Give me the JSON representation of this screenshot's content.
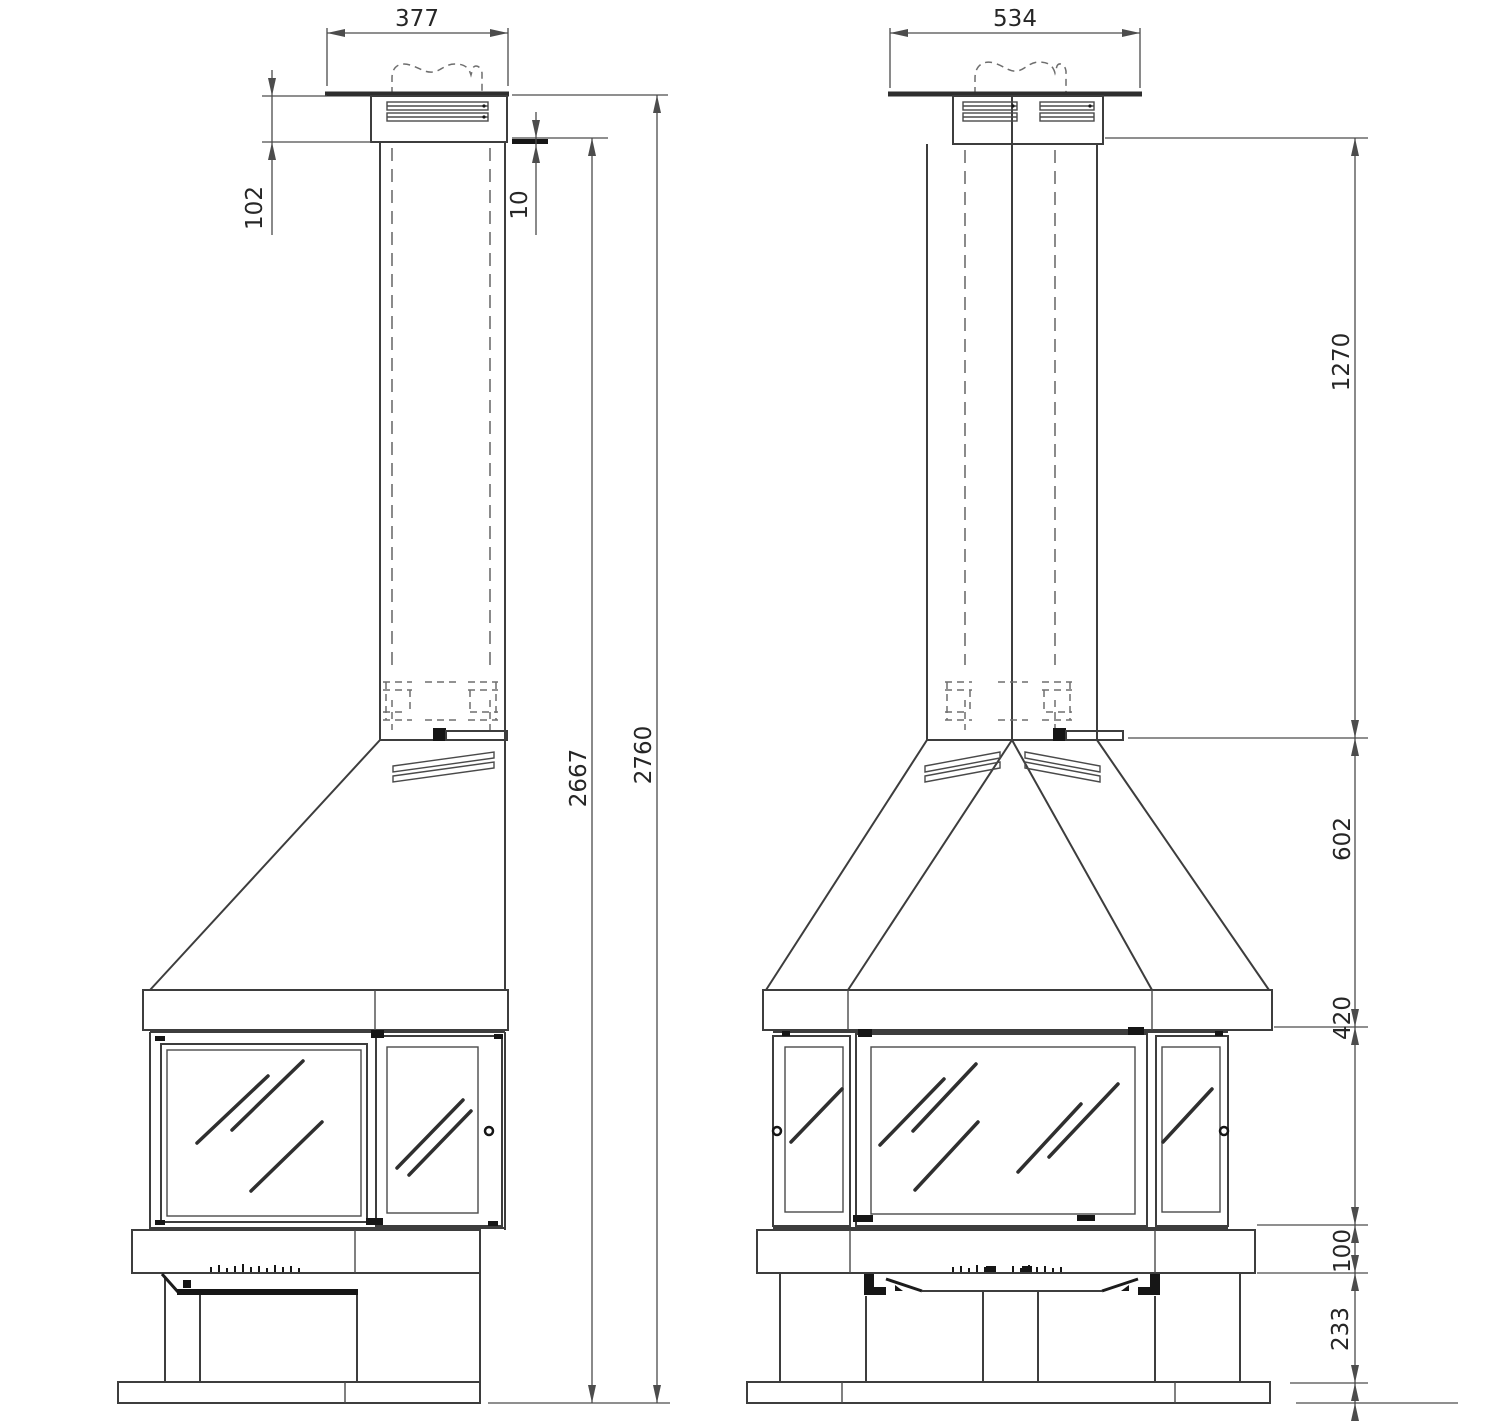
{
  "colors": {
    "background": "#ffffff",
    "line": "#3d3d3d",
    "dark_detail": "#161616",
    "dimension": "#4c4c4c",
    "label_text": "#262626"
  },
  "side_view": {
    "dims": {
      "top_width": "377",
      "cap_height": "102",
      "cap_overlap": "10",
      "height_without_cap": "2667",
      "total_height": "2760"
    }
  },
  "front_view": {
    "dims": {
      "top_width": "534",
      "chimney_height": "1270",
      "hood_height": "602",
      "firebox_height": "420",
      "shelf_height": "100",
      "plinth_height": "233"
    }
  }
}
